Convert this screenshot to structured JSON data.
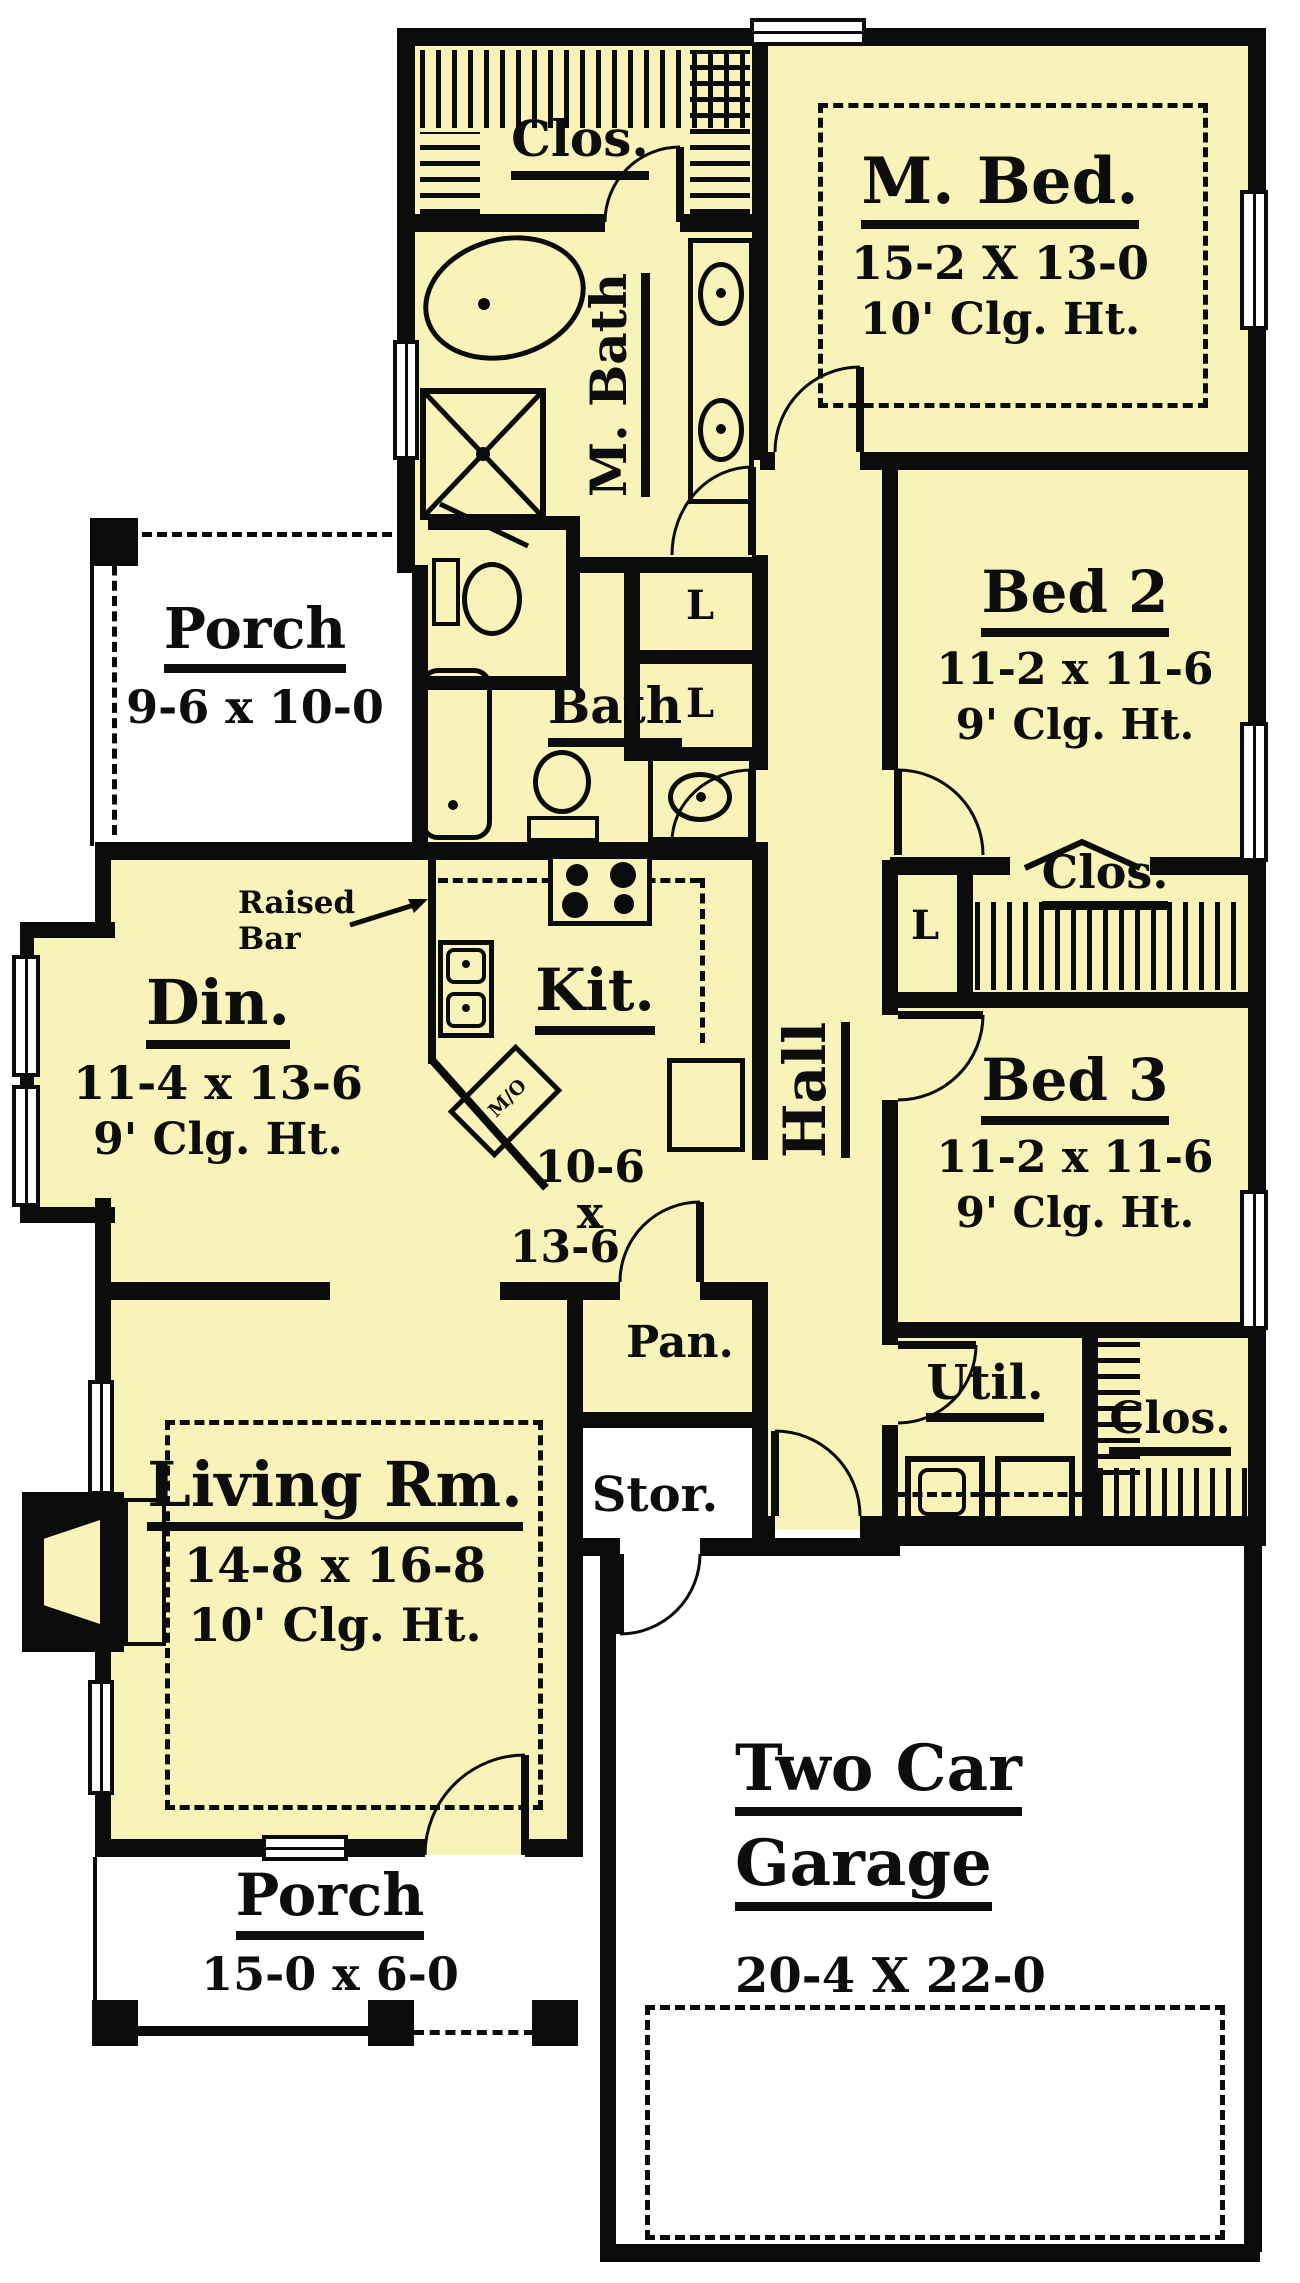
{
  "colors": {
    "floor": "#F8F3B8",
    "wall": "#000000",
    "porch": "#FFFFFF"
  },
  "rooms": {
    "master_closet": {
      "name": "Clos."
    },
    "master_bed": {
      "name": "M. Bed.",
      "dims": "15-2 X 13-0",
      "ceiling": "10' Clg. Ht."
    },
    "master_bath": {
      "name": "M. Bath"
    },
    "bed2": {
      "name": "Bed 2",
      "dims": "11-2 x 11-6",
      "ceiling": "9' Clg. Ht."
    },
    "side_porch": {
      "name": "Porch",
      "dims": "9-6 x 10-0"
    },
    "bath": {
      "name": "Bath"
    },
    "linen1": {
      "name": "L"
    },
    "linen2": {
      "name": "L"
    },
    "linen3": {
      "name": "L"
    },
    "bed2_closet": {
      "name": "Clos."
    },
    "raised_bar": {
      "line1": "Raised",
      "line2": "Bar"
    },
    "dining": {
      "name": "Din.",
      "dims": "11-4 x 13-6",
      "ceiling": "9' Clg. Ht."
    },
    "kitchen": {
      "name": "Kit.",
      "dims_line1": "10-6 x",
      "dims_line2": "13-6",
      "microwave": "M/O"
    },
    "hall": {
      "name": "Hall"
    },
    "bed3": {
      "name": "Bed 3",
      "dims": "11-2 x 11-6",
      "ceiling": "9' Clg. Ht."
    },
    "pantry": {
      "name": "Pan."
    },
    "utility": {
      "name": "Util."
    },
    "utility_closet": {
      "name": "Clos."
    },
    "storage": {
      "name": "Stor."
    },
    "living": {
      "name": "Living Rm.",
      "dims": "14-8 x 16-8",
      "ceiling": "10' Clg. Ht."
    },
    "garage": {
      "name_line1": "Two Car",
      "name_line2": "Garage",
      "dims": "20-4 X 22-0"
    },
    "front_porch": {
      "name": "Porch",
      "dims": "15-0 x 6-0"
    }
  }
}
